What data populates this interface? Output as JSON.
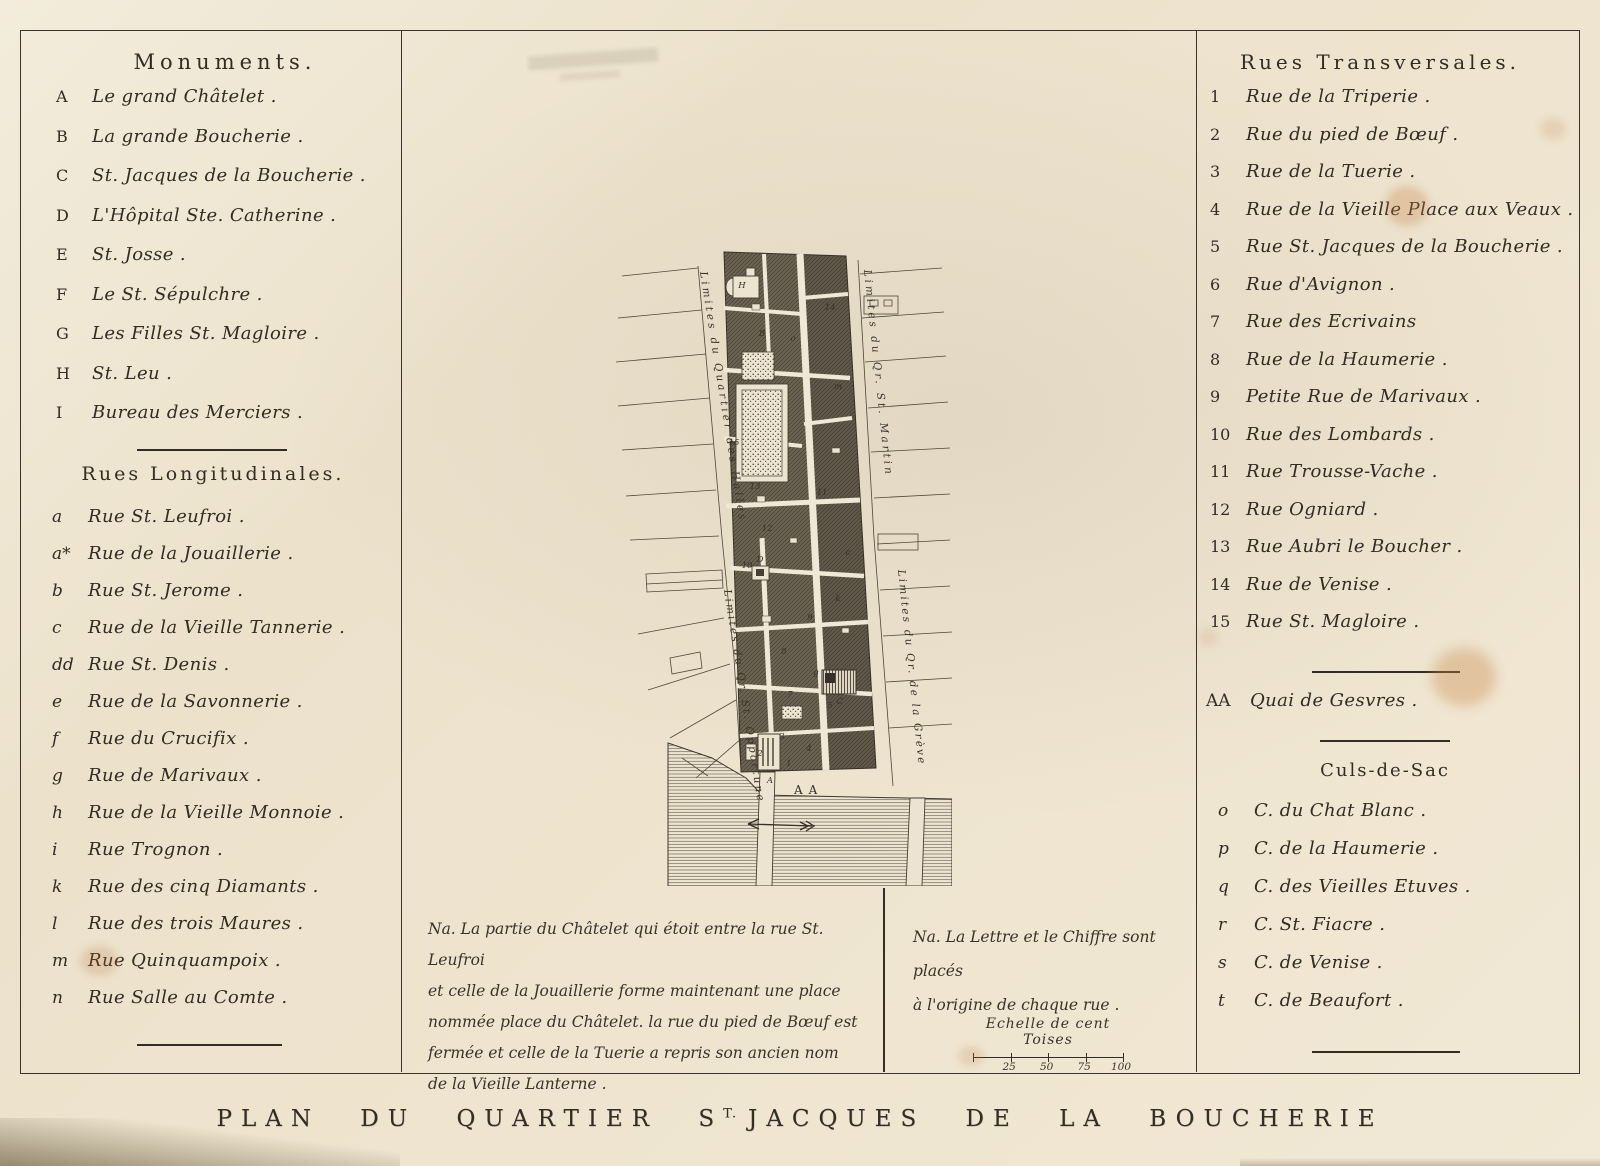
{
  "plate": {
    "title_pre": "PLAN DU QUARTIER S",
    "title_sup": "T.",
    "title_post": "JACQUES DE LA BOUCHERIE"
  },
  "monuments": {
    "heading": "Monuments.",
    "items": [
      {
        "key": "A",
        "label": "Le grand Châtelet ."
      },
      {
        "key": "B",
        "label": "La grande Boucherie ."
      },
      {
        "key": "C",
        "label": "St. Jacques de la Boucherie ."
      },
      {
        "key": "D",
        "label": "L'Hôpital Ste. Catherine ."
      },
      {
        "key": "E",
        "label": "St. Josse ."
      },
      {
        "key": "F",
        "label": "Le St. Sépulchre ."
      },
      {
        "key": "G",
        "label": "Les Filles St. Magloire ."
      },
      {
        "key": "H",
        "label": "St. Leu ."
      },
      {
        "key": "I",
        "label": "Bureau des Merciers ."
      }
    ]
  },
  "rues_longitudinales": {
    "heading": "Rues Longitudinales.",
    "items": [
      {
        "key": "a",
        "label": "Rue St. Leufroi ."
      },
      {
        "key": "a*",
        "label": "Rue de la Jouaillerie ."
      },
      {
        "key": "b",
        "label": "Rue St. Jerome ."
      },
      {
        "key": "c",
        "label": "Rue de la Vieille Tannerie ."
      },
      {
        "key": "dd",
        "label": "Rue St. Denis ."
      },
      {
        "key": "e",
        "label": "Rue de la Savonnerie ."
      },
      {
        "key": "f",
        "label": "Rue du Crucifix ."
      },
      {
        "key": "g",
        "label": "Rue de Marivaux ."
      },
      {
        "key": "h",
        "label": "Rue de la Vieille Monnoie ."
      },
      {
        "key": "i",
        "label": "Rue Trognon ."
      },
      {
        "key": "k",
        "label": "Rue des cinq Diamants ."
      },
      {
        "key": "l",
        "label": "Rue des trois Maures ."
      },
      {
        "key": "m",
        "label": "Rue Quinquampoix ."
      },
      {
        "key": "n",
        "label": "Rue Salle au Comte ."
      }
    ]
  },
  "rues_transversales": {
    "heading": "Rues Transversales.",
    "items": [
      {
        "key": "1",
        "label": "Rue de la Triperie ."
      },
      {
        "key": "2",
        "label": "Rue du pied de Bœuf ."
      },
      {
        "key": "3",
        "label": "Rue de la Tuerie ."
      },
      {
        "key": "4",
        "label": "Rue de la Vieille Place aux Veaux ."
      },
      {
        "key": "5",
        "label": "Rue St. Jacques de la Boucherie ."
      },
      {
        "key": "6",
        "label": "Rue d'Avignon ."
      },
      {
        "key": "7",
        "label": "Rue des Ecrivains"
      },
      {
        "key": "8",
        "label": "Rue de la Haumerie ."
      },
      {
        "key": "9",
        "label": "Petite Rue de Marivaux ."
      },
      {
        "key": "10",
        "label": "Rue des Lombards ."
      },
      {
        "key": "11",
        "label": "Rue Trousse-Vache ."
      },
      {
        "key": "12",
        "label": "Rue Ogniard ."
      },
      {
        "key": "13",
        "label": "Rue Aubri le Boucher ."
      },
      {
        "key": "14",
        "label": "Rue de Venise ."
      },
      {
        "key": "15",
        "label": "Rue St. Magloire ."
      }
    ]
  },
  "quai": {
    "key": "AA",
    "label": "Quai de Gesvres ."
  },
  "culs_de_sac": {
    "heading": "Culs-de-Sac",
    "items": [
      {
        "key": "o",
        "label": "C. du Chat Blanc ."
      },
      {
        "key": "p",
        "label": "C. de la Haumerie ."
      },
      {
        "key": "q",
        "label": "C. des Vieilles Etuves ."
      },
      {
        "key": "r",
        "label": "C. St. Fiacre ."
      },
      {
        "key": "s",
        "label": "C. de Venise ."
      },
      {
        "key": "t",
        "label": "C. de Beaufort ."
      }
    ]
  },
  "notes": {
    "note1_lines": [
      "Na. La partie du Châtelet qui étoit entre la rue St. Leufroi",
      "et celle de la Jouaillerie forme maintenant une place",
      "nommée place du Châtelet. la rue du pied de Bœuf est",
      "fermée et celle de la Tuerie a repris son ancien nom",
      "de la Vieille Lanterne ."
    ],
    "note2_lines": [
      "Na. La Lettre et le Chiffre sont placés",
      "à l'origine de chaque rue ."
    ]
  },
  "scale": {
    "label": "Echelle de cent Toises",
    "ticks": [
      "25",
      "50",
      "75",
      "100"
    ]
  },
  "map": {
    "labels": {
      "halles": "Limites du Quartier des Halles",
      "opportune": "Limites du Qr. St. Opportune",
      "martin": "Limites du Qr. St. Martin",
      "greve": "Limites du Qr. de la Grève",
      "quai": "AA"
    },
    "marks": [
      {
        "t": "H",
        "x": 130,
        "y": 50
      },
      {
        "t": "B",
        "x": 150,
        "y": 98
      },
      {
        "t": "o",
        "x": 181,
        "y": 103
      },
      {
        "t": "14",
        "x": 218,
        "y": 72
      },
      {
        "t": "m",
        "x": 226,
        "y": 151
      },
      {
        "t": "15",
        "x": 122,
        "y": 207
      },
      {
        "t": "13",
        "x": 143,
        "y": 251
      },
      {
        "t": "11",
        "x": 210,
        "y": 257
      },
      {
        "t": "12",
        "x": 155,
        "y": 293
      },
      {
        "t": "10",
        "x": 135,
        "y": 330
      },
      {
        "t": "D",
        "x": 148,
        "y": 324
      },
      {
        "t": "c",
        "x": 236,
        "y": 317
      },
      {
        "t": "k",
        "x": 226,
        "y": 363
      },
      {
        "t": "9",
        "x": 198,
        "y": 382
      },
      {
        "t": "8",
        "x": 172,
        "y": 416
      },
      {
        "t": "g",
        "x": 204,
        "y": 437
      },
      {
        "t": "7",
        "x": 178,
        "y": 459
      },
      {
        "t": "5",
        "x": 218,
        "y": 470
      },
      {
        "t": "C",
        "x": 228,
        "y": 466
      },
      {
        "t": "3",
        "x": 170,
        "y": 501
      },
      {
        "t": "4",
        "x": 197,
        "y": 513
      },
      {
        "t": "2",
        "x": 148,
        "y": 518
      },
      {
        "t": "1",
        "x": 177,
        "y": 528
      },
      {
        "t": "A",
        "x": 158,
        "y": 545
      }
    ]
  }
}
